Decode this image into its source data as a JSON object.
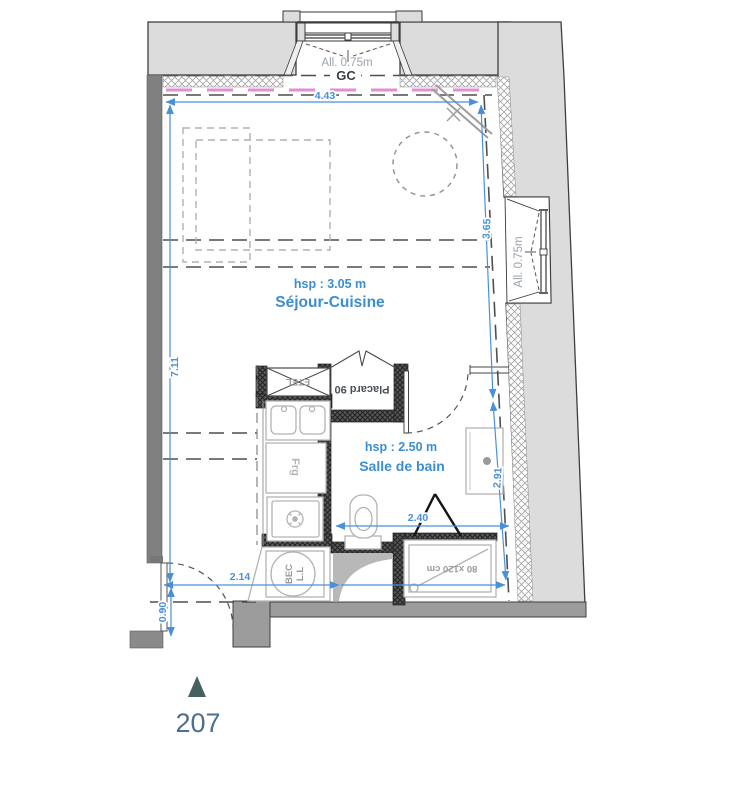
{
  "plan": {
    "unit_number": "207",
    "rooms": {
      "sejour_cuisine": {
        "name": "Séjour-Cuisine",
        "ceiling": "hsp : 3.05 m"
      },
      "salle_de_bain": {
        "name": "Salle de bain",
        "ceiling": "hsp : 2.50 m"
      }
    },
    "windows": {
      "top_sill": "All. 0.75m",
      "right_sill": "All. 0.75m",
      "gc_label": "GC"
    },
    "fixtures": {
      "etel": "ETEL",
      "placard": "Placard 90",
      "fridge": "Frg",
      "washer_line1": "BEC",
      "washer_line2": "L.L",
      "shower_size": "80 x120 cm"
    },
    "dimensions": {
      "top_width": "4.43",
      "left_height": "7.11",
      "right_upper": "3.65",
      "right_lower": "2.91",
      "bath_width": "2.40",
      "lower_width": "2.14",
      "entry_door": "0.90"
    },
    "colors": {
      "dimension_blue": "#4a90d9",
      "label_blue": "#3b8ed0",
      "pink_dashed": "#e08fd2",
      "wall_light": "#dcdcdc",
      "wall_dark": "#808080",
      "unit_text": "#4d6f8f",
      "marker_triangle": "#47605f"
    }
  }
}
